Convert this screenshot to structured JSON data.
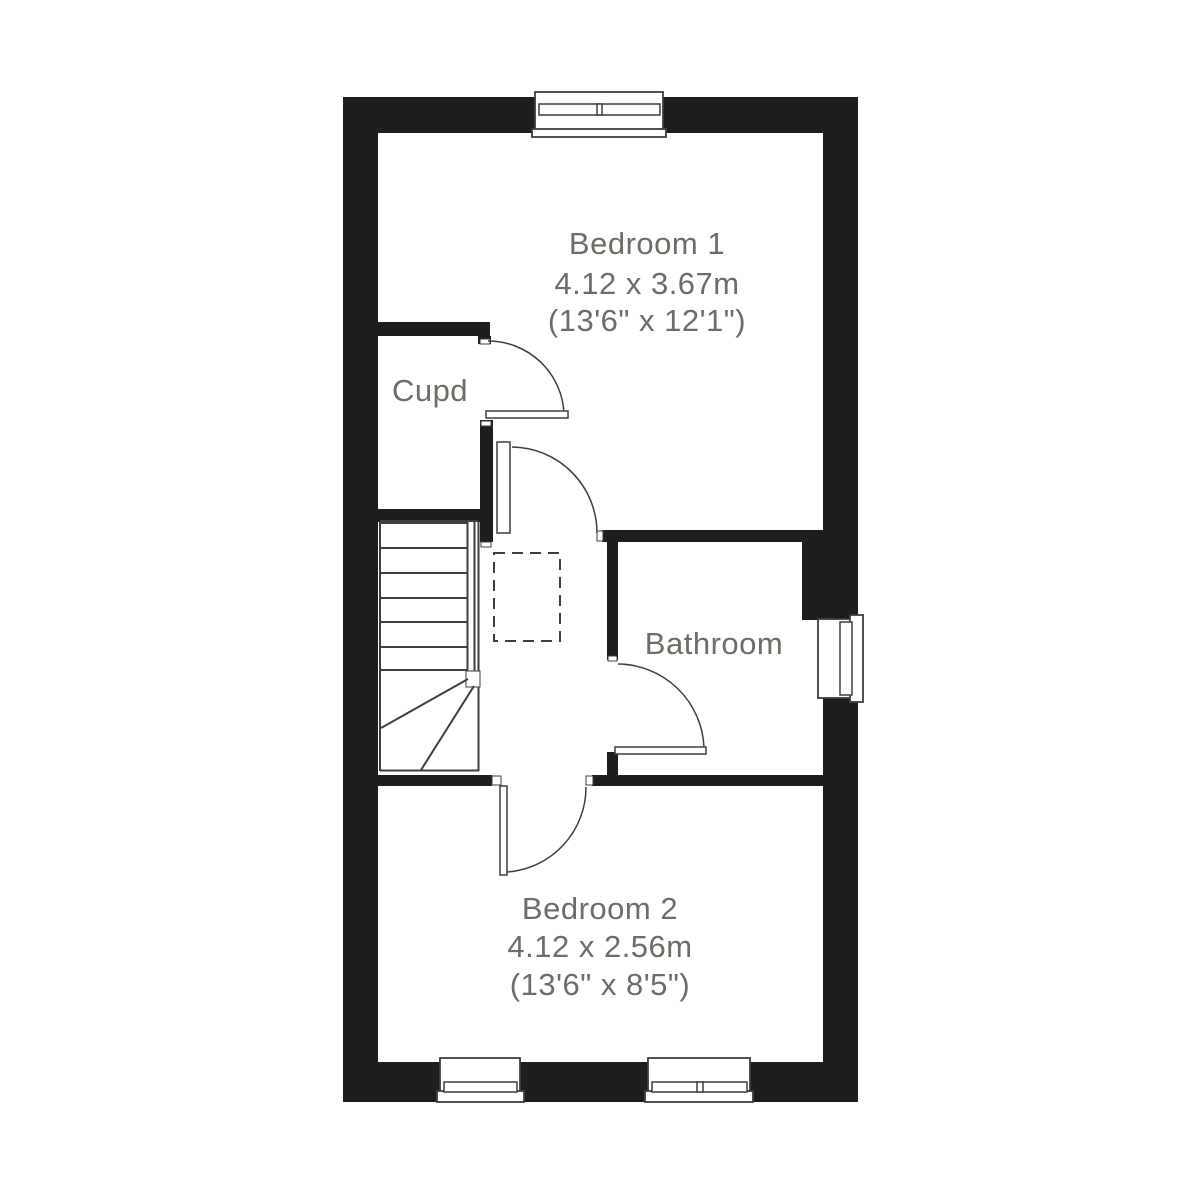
{
  "colors": {
    "wall": "#1f1d1d",
    "line": "#3f3e3a",
    "text": "#6a6e64",
    "bg": "#ffffff"
  },
  "rooms": {
    "bedroom1": {
      "name": "Bedroom 1",
      "metric": "4.12 x 3.67m",
      "imperial": "(13'6\" x 12'1\")"
    },
    "cupboard": {
      "name": "Cupd"
    },
    "bathroom": {
      "name": "Bathroom"
    },
    "bedroom2": {
      "name": "Bedroom 2",
      "metric": "4.12 x 2.56m",
      "imperial": "(13'6\" x 8'5\")"
    }
  }
}
